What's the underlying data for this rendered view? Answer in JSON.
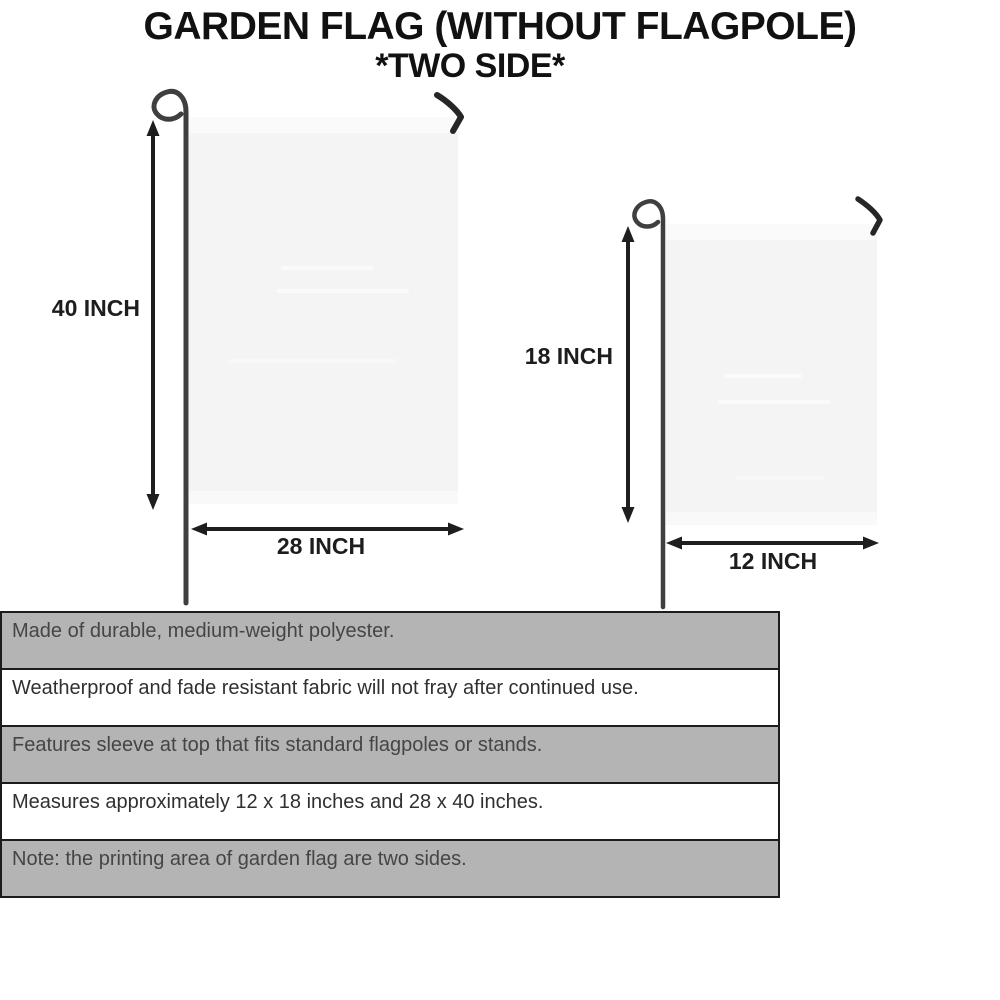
{
  "title": {
    "line1": "GARDEN FLAG (WITHOUT FLAGPOLE)",
    "line2": "*TWO SIDE*"
  },
  "diagram": {
    "large_flag": {
      "height_label": "40 INCH",
      "width_label": "28 INCH"
    },
    "small_flag": {
      "height_label": "18 INCH",
      "width_label": "12 INCH"
    }
  },
  "features": [
    {
      "text": "Made of durable, medium-weight polyester."
    },
    {
      "text": "Weatherproof and fade resistant fabric will not fray after continued use."
    },
    {
      "text": "Features sleeve at top that fits standard flagpoles or stands."
    },
    {
      "text": "Measures approximately 12 x 18 inches and 28 x 40 inches."
    },
    {
      "text": "Note: the printing area of garden flag are two sides."
    }
  ],
  "colors": {
    "band_gray": "#b4b4b4",
    "band_border": "#1c1c1c",
    "flag_fill": "#f4f4f5",
    "line_black": "#1e1e1e",
    "pole_gray": "#3f3f3f",
    "label_text": "#1d1d1d",
    "feature_text_gray_band": "#454545",
    "feature_text_white_band": "#303030"
  }
}
